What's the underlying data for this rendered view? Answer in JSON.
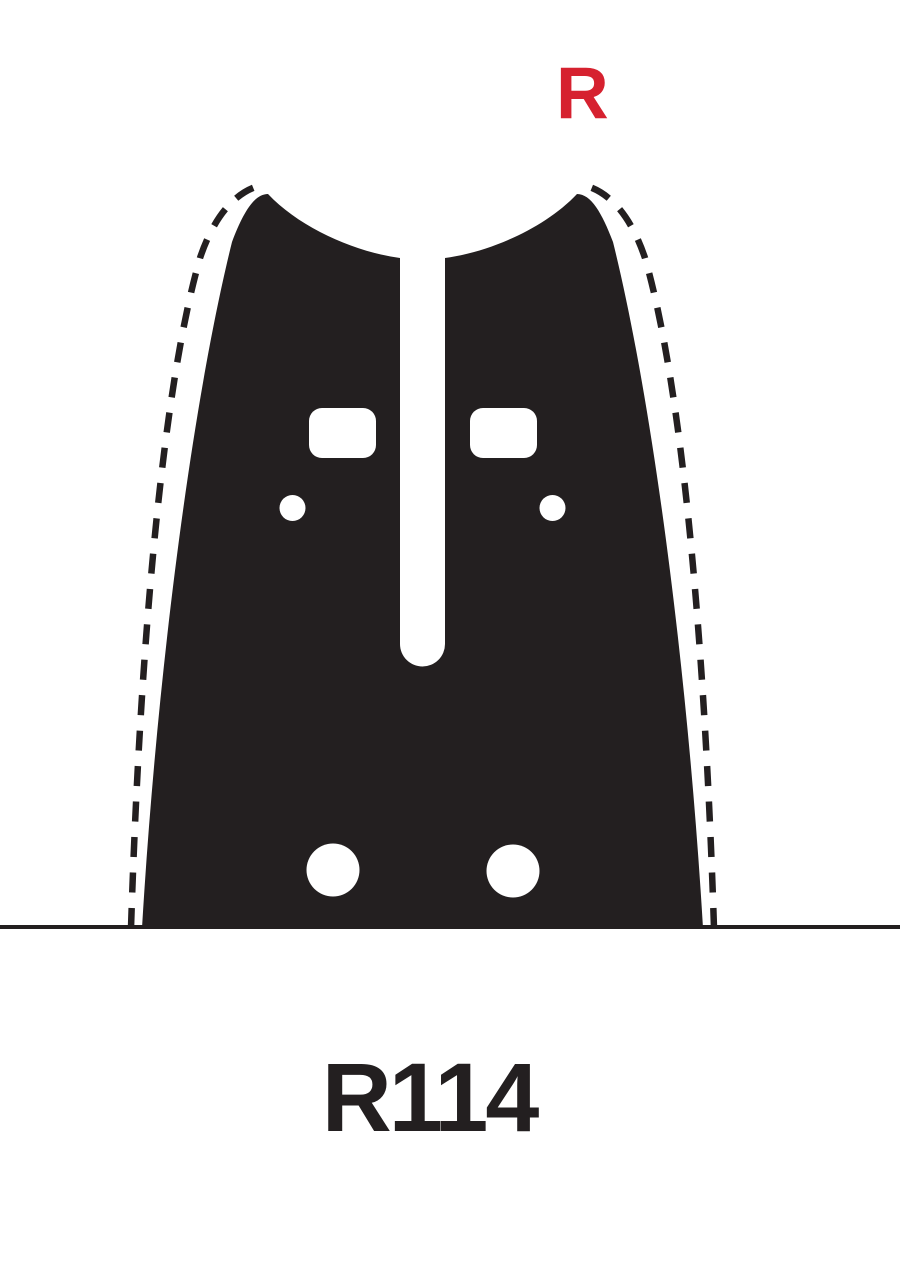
{
  "labels": {
    "orientation": "R",
    "model": "R114"
  },
  "colors": {
    "ink": "#231f20",
    "accent_red": "#d6212f",
    "background": "#ffffff"
  },
  "diagram": {
    "subject": "chainsaw-guide-bar-mount-pattern",
    "features": {
      "guide_slot": "central vertical slot, round bottom",
      "adjuster_holes": 2,
      "oiler_holes": 2,
      "bolt_holes": 2,
      "dashed_outline": "bar body edge shown dashed on both flanks",
      "baseline": "horizontal rule across full page width"
    }
  }
}
